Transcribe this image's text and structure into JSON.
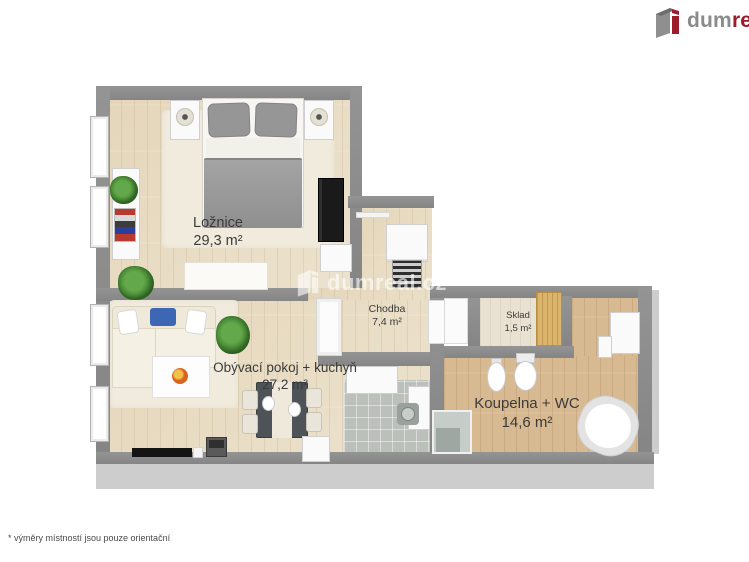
{
  "logo": {
    "gray": "dum",
    "red": "real",
    "icon": "dumreal-building-icon"
  },
  "watermark": {
    "text": "dumreal.cz",
    "icon": "dumreal-building-icon"
  },
  "footer": {
    "note": "* výměry místností jsou pouze orientační"
  },
  "rooms": [
    {
      "id": "loznice",
      "name": "Ložnice",
      "area": "29,3 m²"
    },
    {
      "id": "chodba",
      "name": "Chodba",
      "area": "7,4 m²"
    },
    {
      "id": "sklad",
      "name": "Sklad",
      "area": "1,5 m²"
    },
    {
      "id": "obyvaci-pokoj-kuchyn",
      "name": "Obývací pokoj + kuchyň",
      "area": "27,2 m²"
    },
    {
      "id": "koupelna-wc",
      "name": "Koupelna + WC",
      "area": "14,6 m²"
    }
  ],
  "colors": {
    "brand_red": "#9c1b2d",
    "logo_gray": "#8b8b8b",
    "wall": "#8c8c8c",
    "wall_face": "#cdcdcd",
    "floor_light_wood": "#e9dec7",
    "floor_dark_wood": "#d8ba92",
    "floor_tile": "#bcc0bb",
    "label_text": "#3b3b3b",
    "watermark_white": "rgba(255,255,255,0.62)"
  }
}
